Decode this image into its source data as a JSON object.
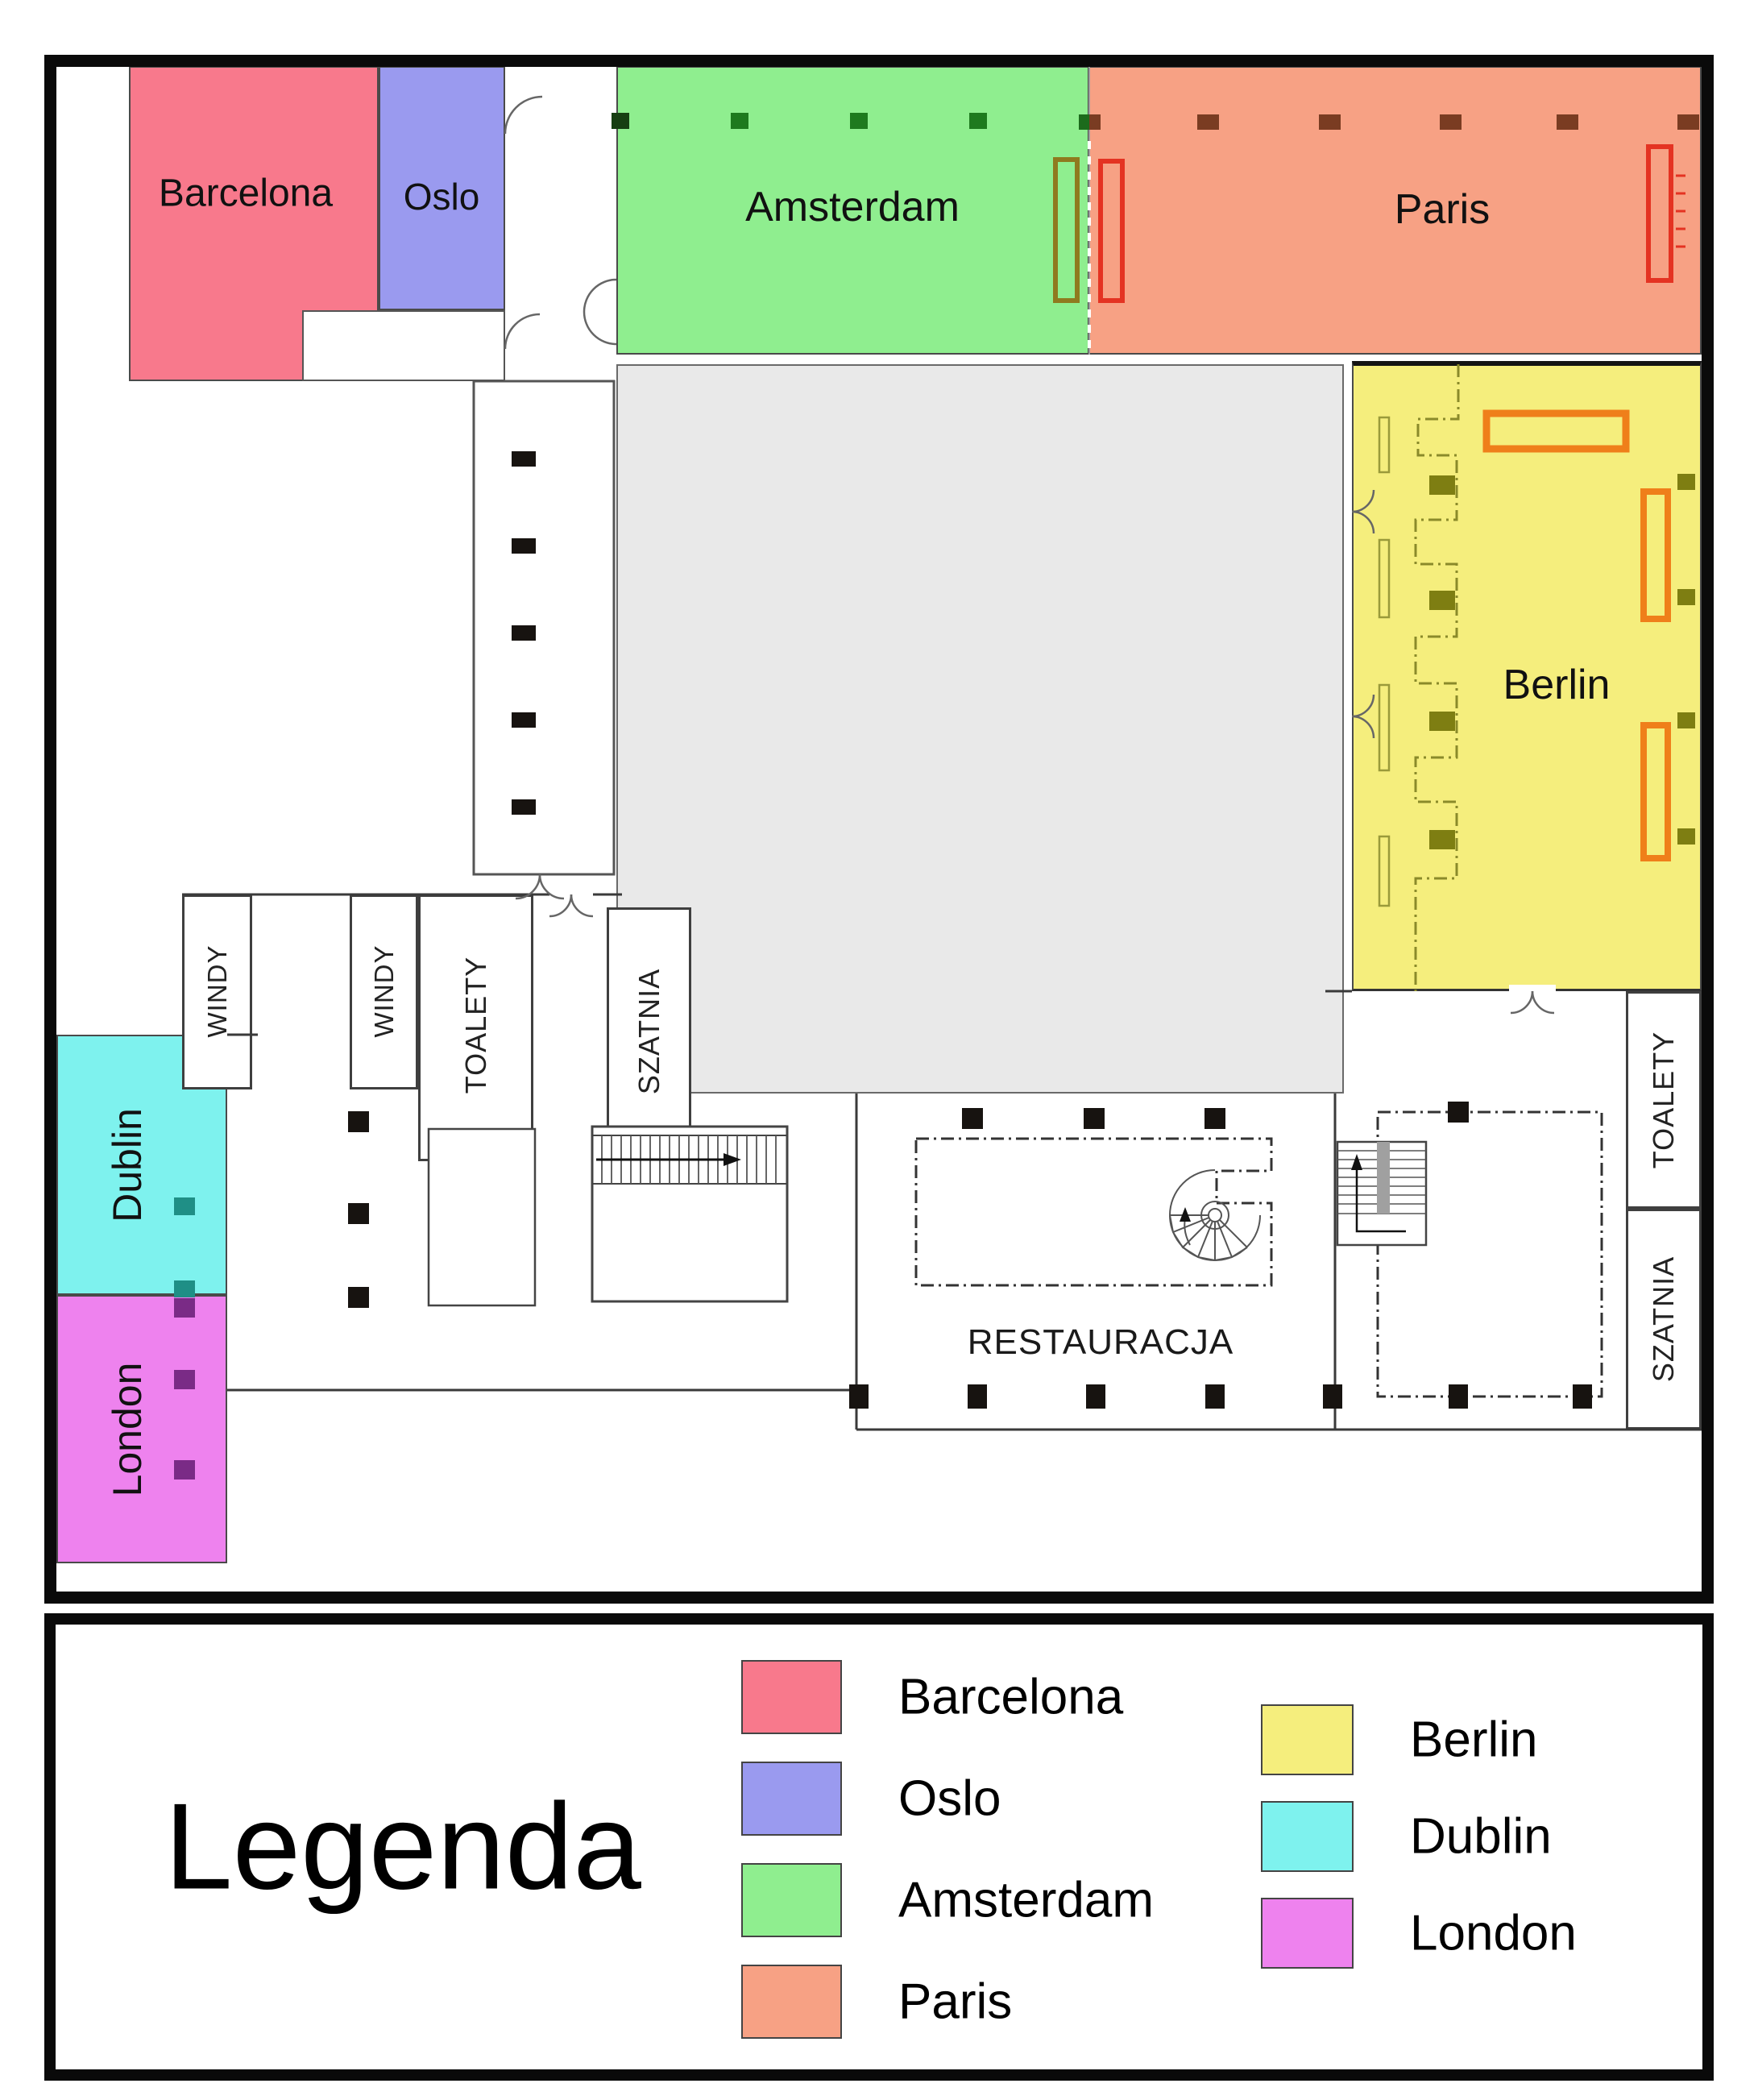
{
  "rooms": {
    "barcelona": {
      "label": "Barcelona",
      "color": "#f8798c"
    },
    "oslo": {
      "label": "Oslo",
      "color": "#9a9aef"
    },
    "amsterdam": {
      "label": "Amsterdam",
      "color": "#8fee8f"
    },
    "paris": {
      "label": "Paris",
      "color": "#f7a184"
    },
    "berlin": {
      "label": "Berlin",
      "color": "#f5ee7d"
    },
    "dublin": {
      "label": "Dublin",
      "color": "#7ef2ee"
    },
    "london": {
      "label": "London",
      "color": "#ee82ee"
    }
  },
  "facilities": {
    "windy": "WINDY",
    "toalety": "TOALETY",
    "szatnia": "SZATNIA",
    "restauracja": "RESTAURACJA"
  },
  "legend": {
    "title": "Legenda",
    "column1": [
      {
        "label": "Barcelona",
        "color": "#f8798c"
      },
      {
        "label": "Oslo",
        "color": "#9a9aef"
      },
      {
        "label": "Amsterdam",
        "color": "#8fee8f"
      },
      {
        "label": "Paris",
        "color": "#f7a184"
      }
    ],
    "column2": [
      {
        "label": "Berlin",
        "color": "#f5ee7d"
      },
      {
        "label": "Dublin",
        "color": "#7ef2ee"
      },
      {
        "label": "London",
        "color": "#ee82ee"
      }
    ]
  }
}
